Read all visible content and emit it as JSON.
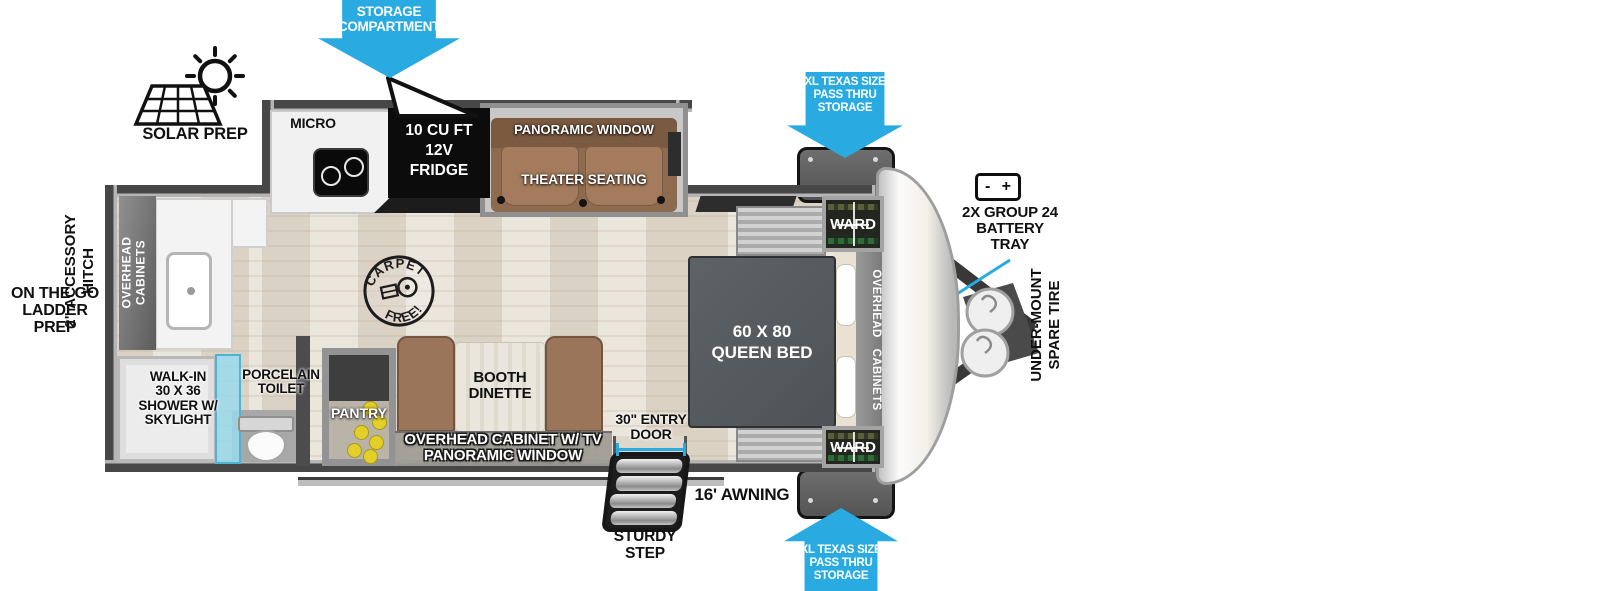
{
  "title": "Travel trailer floorplan",
  "colors": {
    "callout_blue": "#29abe2",
    "wall_gray": "#4c4c4c",
    "seat_brown": "#9b755a",
    "bed_gray": "#575c61",
    "shower_glass": "#9fdcef",
    "pantry_item_yellow": "#e3cf2a"
  },
  "exterior": {
    "storage_compartment": {
      "line1": "STORAGE",
      "line2": "COMPARTMENT"
    },
    "pass_thru_top": [
      "XL TEXAS SIZE",
      "PASS THRU",
      "STORAGE"
    ],
    "pass_thru_bottom": [
      "XL TEXAS SIZE",
      "PASS THRU",
      "STORAGE"
    ],
    "solar_prep": "SOLAR PREP",
    "accessory_hitch": {
      "line1": "2\" ACCESSORY",
      "line2": "HITCH"
    },
    "ladder_prep": {
      "line1": "ON THE GO",
      "line2": "LADDER PREP"
    },
    "battery": {
      "minus": "-",
      "plus": "+",
      "line1": "2X GROUP 24",
      "line2": "BATTERY",
      "line3": "TRAY"
    },
    "spare_tire": {
      "line1": "UNDER-MOUNT",
      "line2": "SPARE TIRE"
    },
    "entry_door": {
      "line1": "30\" ENTRY",
      "line2": "DOOR"
    },
    "awning": "16' AWNING",
    "sturdy_step": {
      "line1": "STURDY",
      "line2": "STEP"
    }
  },
  "interior": {
    "micro": "MICRO",
    "fridge": {
      "line1": "10 CU FT",
      "line2": "12V",
      "line3": "FRIDGE"
    },
    "panoramic_window": "PANORAMIC WINDOW",
    "theater_seating": "THEATER SEATING",
    "carpet_free": {
      "top": "CARPET",
      "bottom": "FREE!"
    },
    "overhead_cabinets_rear": {
      "line1": "OVERHEAD",
      "line2": "CABINETS"
    },
    "overhead_cabinets_front": {
      "line1": "OVERHEAD",
      "line2": "CABINETS"
    },
    "ward_top": "WARD",
    "ward_bottom": "WARD",
    "queen_bed": {
      "line1": "60 X 80",
      "line2": "QUEEN BED"
    },
    "shower": {
      "line1": "WALK-IN",
      "line2": "30 X 36",
      "line3": "SHOWER W/",
      "line4": "SKYLIGHT"
    },
    "toilet": {
      "line1": "PORCELAIN",
      "line2": "TOILET"
    },
    "pantry": "PANTRY",
    "dinette": {
      "line1": "BOOTH",
      "line2": "DINETTE"
    },
    "overhead_cabinet_tv": {
      "line1": "OVERHEAD CABINET W/ TV",
      "line2": "PANORAMIC WINDOW"
    }
  }
}
